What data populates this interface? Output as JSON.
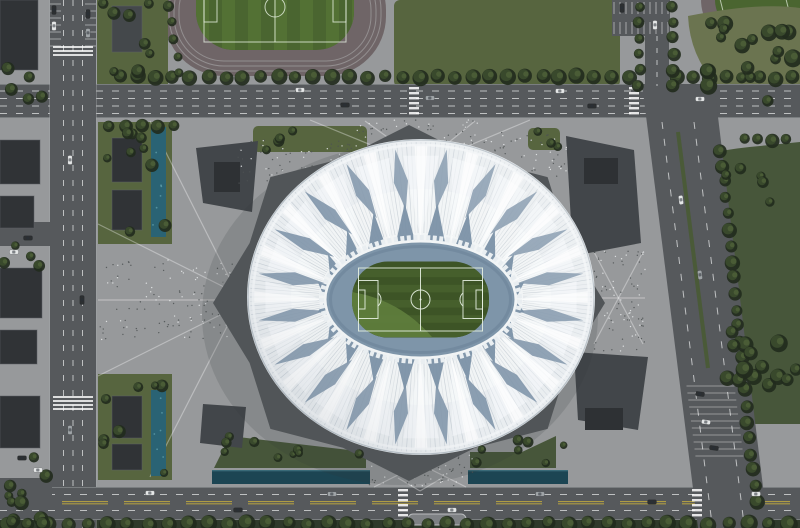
{
  "scene": {
    "description": "Aerial rendering of a white lotus-shaped football stadium on a gray plaza, surrounded by roads, canals, lawns, tree rows and small dark buildings; green pitch with white markings at center",
    "colors": {
      "plaza": "#97999b",
      "road": "#56595c",
      "roadLight": "#6a6d70",
      "curb": "#a7aaac",
      "laneWhite": "#d9dbdc",
      "laneYellow": "#b3a041",
      "lawn": "#57653f",
      "lawnDark": "#47563a",
      "olive": "#6b7450",
      "field": "#4a6530",
      "fieldStripe": "#537134",
      "track": "#6f6567",
      "treeDark": "#222b1d",
      "treeMid": "#39492c",
      "treeLight": "#4e5f38",
      "water": "#2a6374",
      "waterDark": "#1c4553",
      "waterLight": "#6fb0ba",
      "bldg": "#303336",
      "bldgLight": "#44484b",
      "ridge": "#5c6063",
      "podium": "#515558",
      "wedge": "#42464a",
      "wedgeBldg": "#2e3134",
      "roof": "#e9edf0",
      "roofLight": "#f2f5f6",
      "rib": "#a9b5c0",
      "gap": "#7e94a9",
      "spike": "#7b91a6",
      "ring": "#e9eef1",
      "opening": "#7e95a9",
      "pitch": "#3d5426",
      "pitchStripe": "#465f2c",
      "pitchLight": "#5f7e3d",
      "mark": "#e6f0e1",
      "shadow": "#31363a",
      "dotDark": "#4e5254",
      "dotLight": "#e8eaeb",
      "pathLine": "#ffffff"
    },
    "stadium": {
      "cx": 421,
      "cy": 297,
      "rx": 174,
      "ry": 158,
      "ribs": 220,
      "petals": 20,
      "ribInnerRx": 102,
      "ribInnerRy": 64,
      "opening": {
        "cx": 420.5,
        "cy": 299.5,
        "rx": 94,
        "ry": 57
      },
      "pitch": {
        "x": 352,
        "y": 261.5,
        "w": 137,
        "h": 76,
        "r": 36
      },
      "podium": {
        "cx": 409,
        "cy": 303,
        "rx": 196,
        "ry": 178,
        "inner": 0.88
      }
    },
    "treeRows": [
      [
        120,
        77,
        17.6,
        0,
        30,
        7
      ],
      [
        676,
        78,
        16.5,
        0,
        8,
        6.5
      ],
      [
        125,
        127,
        16,
        0,
        4,
        6
      ],
      [
        639,
        6,
        0,
        16,
        6,
        5.5
      ],
      [
        673,
        6,
        0,
        16,
        6,
        6
      ],
      [
        721,
        150,
        1.6,
        16,
        23,
        6.5
      ],
      [
        8,
        524,
        20,
        0,
        40,
        7.5
      ],
      [
        168,
        6,
        3,
        17,
        5,
        5
      ],
      [
        744,
        140,
        14,
        0,
        4,
        6
      ]
    ],
    "treeClusters": [
      [
        98,
        124,
        70,
        116,
        10,
        4,
        7
      ],
      [
        98,
        376,
        70,
        100,
        8,
        4,
        7
      ],
      [
        97,
        2,
        70,
        82,
        8,
        4,
        7
      ],
      [
        2,
        44,
        46,
        58,
        5,
        4,
        7
      ],
      [
        2,
        228,
        46,
        42,
        4,
        4,
        6
      ],
      [
        2,
        450,
        46,
        72,
        6,
        4,
        7
      ],
      [
        692,
        20,
        104,
        82,
        18,
        5,
        9
      ],
      [
        726,
        160,
        66,
        54,
        5,
        4,
        6
      ],
      [
        726,
        328,
        72,
        90,
        14,
        5,
        9
      ],
      [
        220,
        436,
        140,
        26,
        9,
        3.5,
        6
      ],
      [
        472,
        440,
        92,
        26,
        7,
        3.5,
        6
      ],
      [
        254,
        126,
        42,
        24,
        4,
        4,
        6
      ],
      [
        528,
        126,
        34,
        24,
        3,
        4,
        6
      ],
      [
        0,
        498,
        62,
        28,
        5,
        5,
        8
      ]
    ],
    "carColors": {
      "w": "#e5e7e7",
      "d": "#2c2f31",
      "s": "#9fa4a7"
    },
    "cars": [
      [
        300,
        90,
        0,
        "w"
      ],
      [
        345,
        105,
        0,
        "d"
      ],
      [
        430,
        98,
        0,
        "s"
      ],
      [
        560,
        91,
        0,
        "w"
      ],
      [
        592,
        106,
        0,
        "d"
      ],
      [
        700,
        99,
        0,
        "w"
      ],
      [
        150,
        493,
        0,
        "w"
      ],
      [
        238,
        510,
        0,
        "d"
      ],
      [
        332,
        494,
        0,
        "s"
      ],
      [
        452,
        510,
        0,
        "w"
      ],
      [
        540,
        494,
        0,
        "s"
      ],
      [
        652,
        502,
        0,
        "d"
      ],
      [
        756,
        494,
        0,
        "w"
      ],
      [
        70,
        160,
        90,
        "w"
      ],
      [
        82,
        300,
        90,
        "d"
      ],
      [
        70,
        430,
        90,
        "s"
      ],
      [
        681,
        200,
        83,
        "w"
      ],
      [
        700,
        275,
        83,
        "s"
      ],
      [
        700,
        394,
        8,
        "d"
      ],
      [
        706,
        422,
        8,
        "w"
      ],
      [
        714,
        448,
        8,
        "d"
      ],
      [
        622,
        8,
        90,
        "d"
      ],
      [
        655,
        25,
        90,
        "w"
      ],
      [
        54,
        10,
        90,
        "d"
      ],
      [
        54,
        26,
        90,
        "w"
      ],
      [
        88,
        14,
        90,
        "d"
      ],
      [
        88,
        33,
        90,
        "s"
      ],
      [
        28,
        238,
        0,
        "d"
      ],
      [
        14,
        252,
        0,
        "w"
      ],
      [
        22,
        458,
        0,
        "d"
      ],
      [
        38,
        470,
        0,
        "w"
      ]
    ],
    "speckleZones": [
      [
        356,
        120,
        122,
        42,
        110
      ],
      [
        100,
        260,
        146,
        80,
        130
      ],
      [
        594,
        248,
        52,
        106,
        90
      ],
      [
        368,
        452,
        106,
        34,
        70
      ],
      [
        238,
        140,
        114,
        44,
        70
      ],
      [
        476,
        132,
        92,
        46,
        60
      ]
    ]
  }
}
